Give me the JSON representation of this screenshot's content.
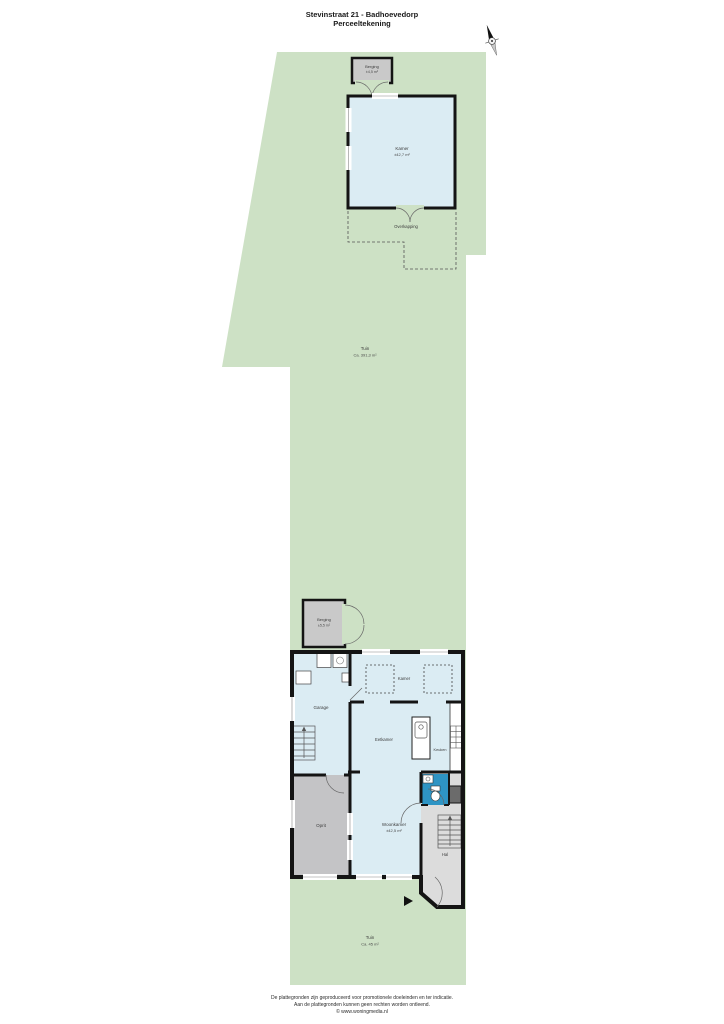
{
  "page": {
    "title_line1": "Stevinstraat 21 - Badhoevedorp",
    "title_line2": "Perceeltekening"
  },
  "plan": {
    "tuin_main": {
      "label": "Tuin",
      "area": "Ca. 391,3 m²"
    },
    "tuin_front": {
      "label": "Tuin",
      "area": "Ca. 45 m²"
    },
    "berging_top": {
      "label": "Berging",
      "area": "±4,5 m²"
    },
    "kamer_outbuilding": {
      "label": "Kamer",
      "area": "±42,7 m²"
    },
    "overkapping": {
      "label": "Overkapping"
    },
    "berging_mid": {
      "label": "Berging",
      "area": "±5,5 m²"
    },
    "garage": {
      "label": "Garage"
    },
    "kamer": {
      "label": "Kamer"
    },
    "eetkamer": {
      "label": "Eetkamer"
    },
    "keuken": {
      "label": "Keuken"
    },
    "oprit": {
      "label": "Oprit"
    },
    "woonkamer": {
      "label": "Woonkamer",
      "area": "±42,5 m²"
    },
    "hal": {
      "label": "Hal"
    }
  },
  "footer": {
    "line1": "De plattegronden zijn geproduceerd voor promotionele doeleinden en ter indicatie.",
    "line2": "Aan de plattegronden kunnen geen rechten worden ontleend.",
    "line3": "© www.woningmedia.nl"
  },
  "colors": {
    "garden": "#cde1c5",
    "room_blue": "#dbecf3",
    "storage_gray": "#c9c9c9",
    "driveway_gray": "#c4c4c6",
    "hallway_gray": "#dcdcdc",
    "tile_blue": "#2e94c4",
    "wall": "#141414"
  }
}
